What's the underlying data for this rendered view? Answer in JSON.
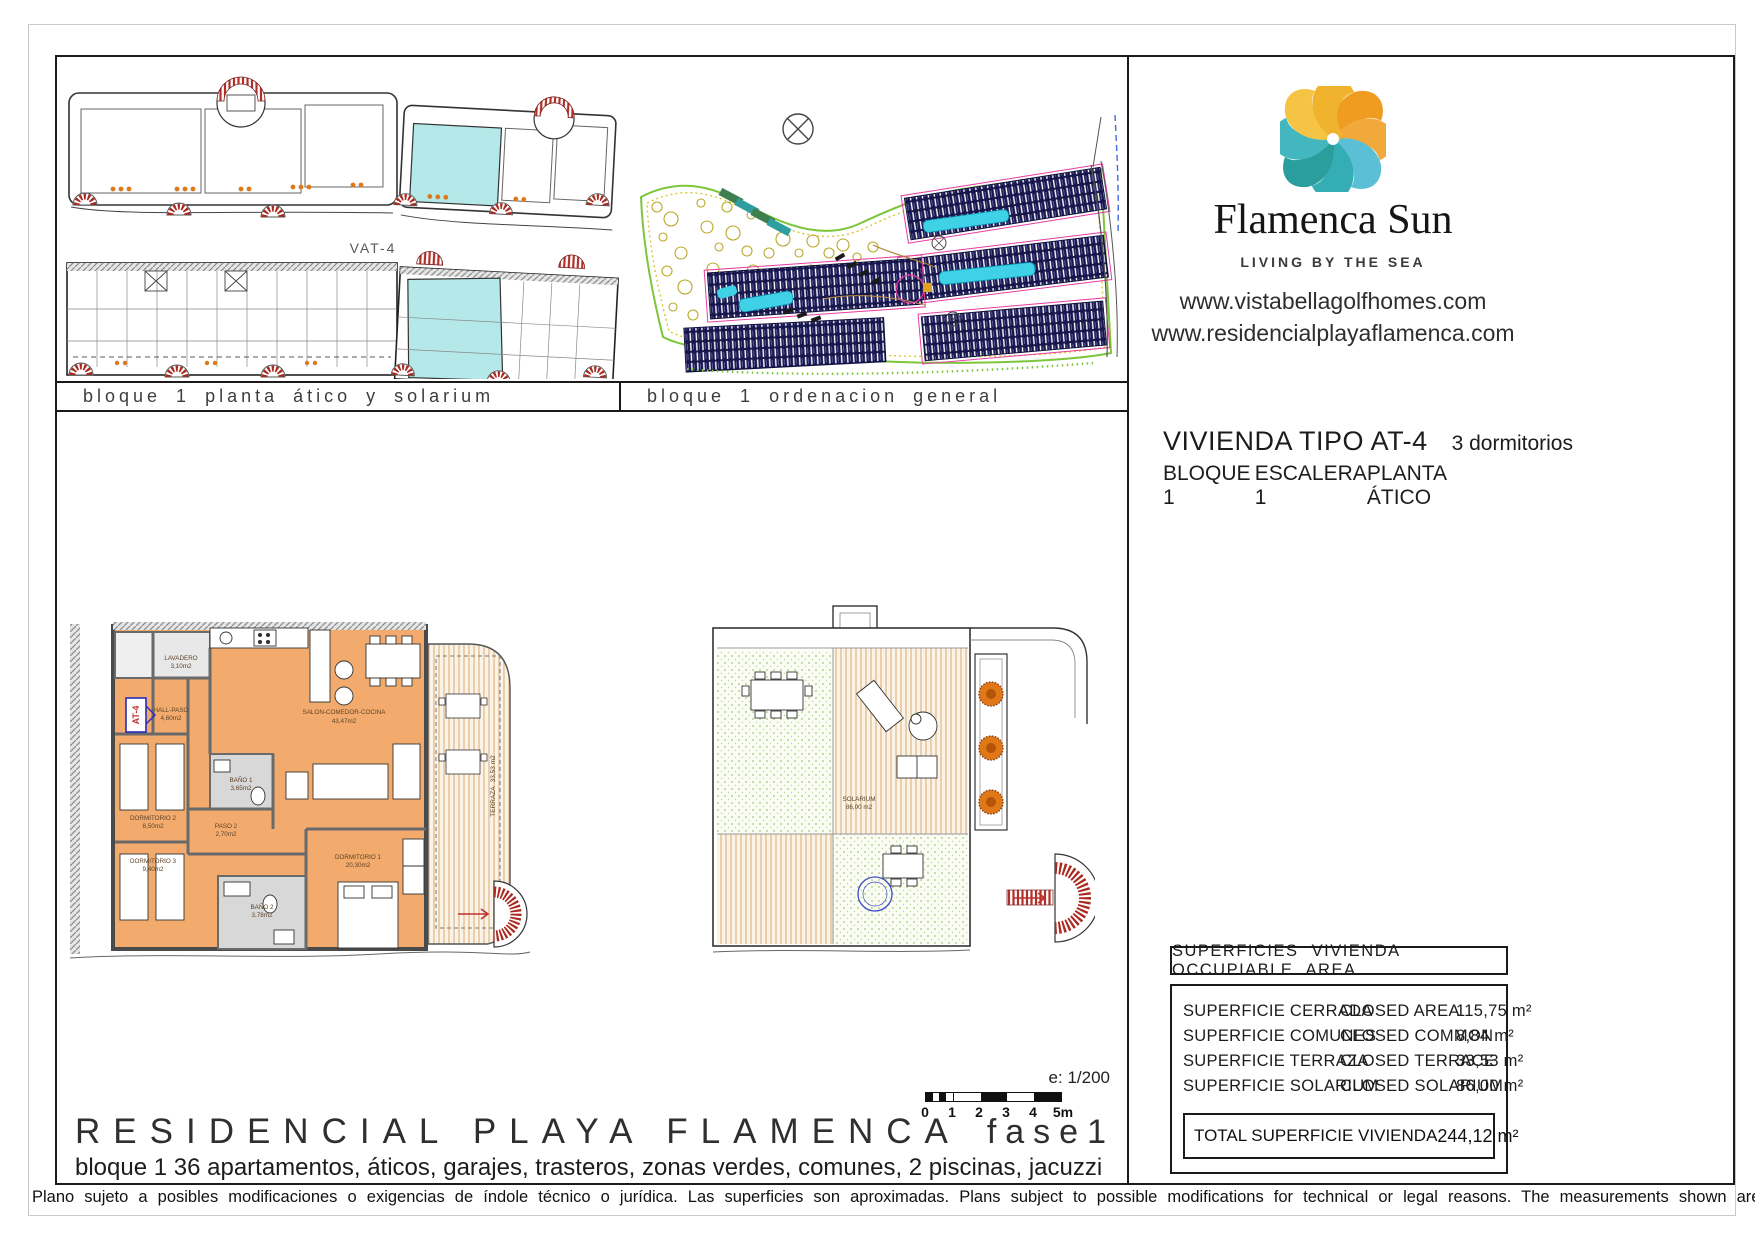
{
  "captions": {
    "plan": "bloque 1 planta ático y solarium",
    "site": "bloque 1 ordenacion general",
    "vat_label": "VAT-4"
  },
  "branding": {
    "name": "Flamenca Sun",
    "tagline": "LIVING BY THE SEA",
    "website1": "www.vistabellagolfhomes.com",
    "website2": "www.residencialplayaflamenca.com",
    "logo_colors": [
      "#ef9c20",
      "#f2a93b",
      "#5bc0d6",
      "#35adb5",
      "#2a9d9d",
      "#43b7c0",
      "#f6c445",
      "#f0b32e"
    ]
  },
  "unit": {
    "title": "VIVIENDA TIPO AT-4",
    "bedrooms": "3 dormitorios",
    "block": "BLOQUE 1",
    "stair": "ESCALERA 1",
    "floor": "PLANTA ÁTICO"
  },
  "floorplan": {
    "unit_tag": "AT-4",
    "rooms": [
      {
        "name": "LAVADERO",
        "area": "3,10m2"
      },
      {
        "name": "HALL-PASO",
        "area": "4,60m2"
      },
      {
        "name": "SALON-COMEDOR-COCINA",
        "area": "43,47m2"
      },
      {
        "name": "BAÑO 1",
        "area": "3,65m2"
      },
      {
        "name": "DORMITORIO 2",
        "area": "8,50m2"
      },
      {
        "name": "PASO 2",
        "area": "2,70m2"
      },
      {
        "name": "DORMITORIO 3",
        "area": "9,40m2"
      },
      {
        "name": "DORMITORIO 1",
        "area": "20,30m2"
      },
      {
        "name": "BAÑO 2",
        "area": "3,78m2"
      },
      {
        "name": "TERRAZA",
        "area": "33,53 m2"
      }
    ]
  },
  "solarium": {
    "name": "SOLARIUM",
    "area": "86,00 m2"
  },
  "areas_table": {
    "header": "SUPERFICIES VIVIENDA OCCUPIABLE AREA",
    "rows": [
      {
        "es": "SUPERFICIE CERRADA",
        "en": "CLOSED AREA",
        "value": "115,75 m²"
      },
      {
        "es": "SUPERFICIE COMUNES",
        "en": "CLOSED COMMON",
        "value": "8,84 m²"
      },
      {
        "es": "SUPERFICIE TERRAZA",
        "en": "CLOSED TERRACE",
        "value": "33,53 m²"
      },
      {
        "es": "SUPERFICIE SOLARIUM",
        "en": "CLOSED SOLARIUM",
        "value": "86,00 m²"
      }
    ],
    "total_label": "TOTAL SUPERFICIE VIVIENDA",
    "total_value": "244,12 m²"
  },
  "scale": {
    "label": "e: 1/200",
    "ticks": [
      "0",
      "1",
      "2",
      "3",
      "4",
      "5m"
    ]
  },
  "footer": {
    "project": "RESIDENCIAL PLAYA FLAMENCA",
    "phase": "fase1",
    "description": "bloque 1   36 apartamentos, áticos, garajes, trasteros, zonas verdes, comunes, 2 piscinas, jacuzzi",
    "disclaimer": "Plano sujeto a posibles modificaciones o exigencias de índole técnico o jurídica. Las superficies son aproximadas. Plans subject to possible modifications for technical or legal reasons. The measurements shown are approximate"
  }
}
